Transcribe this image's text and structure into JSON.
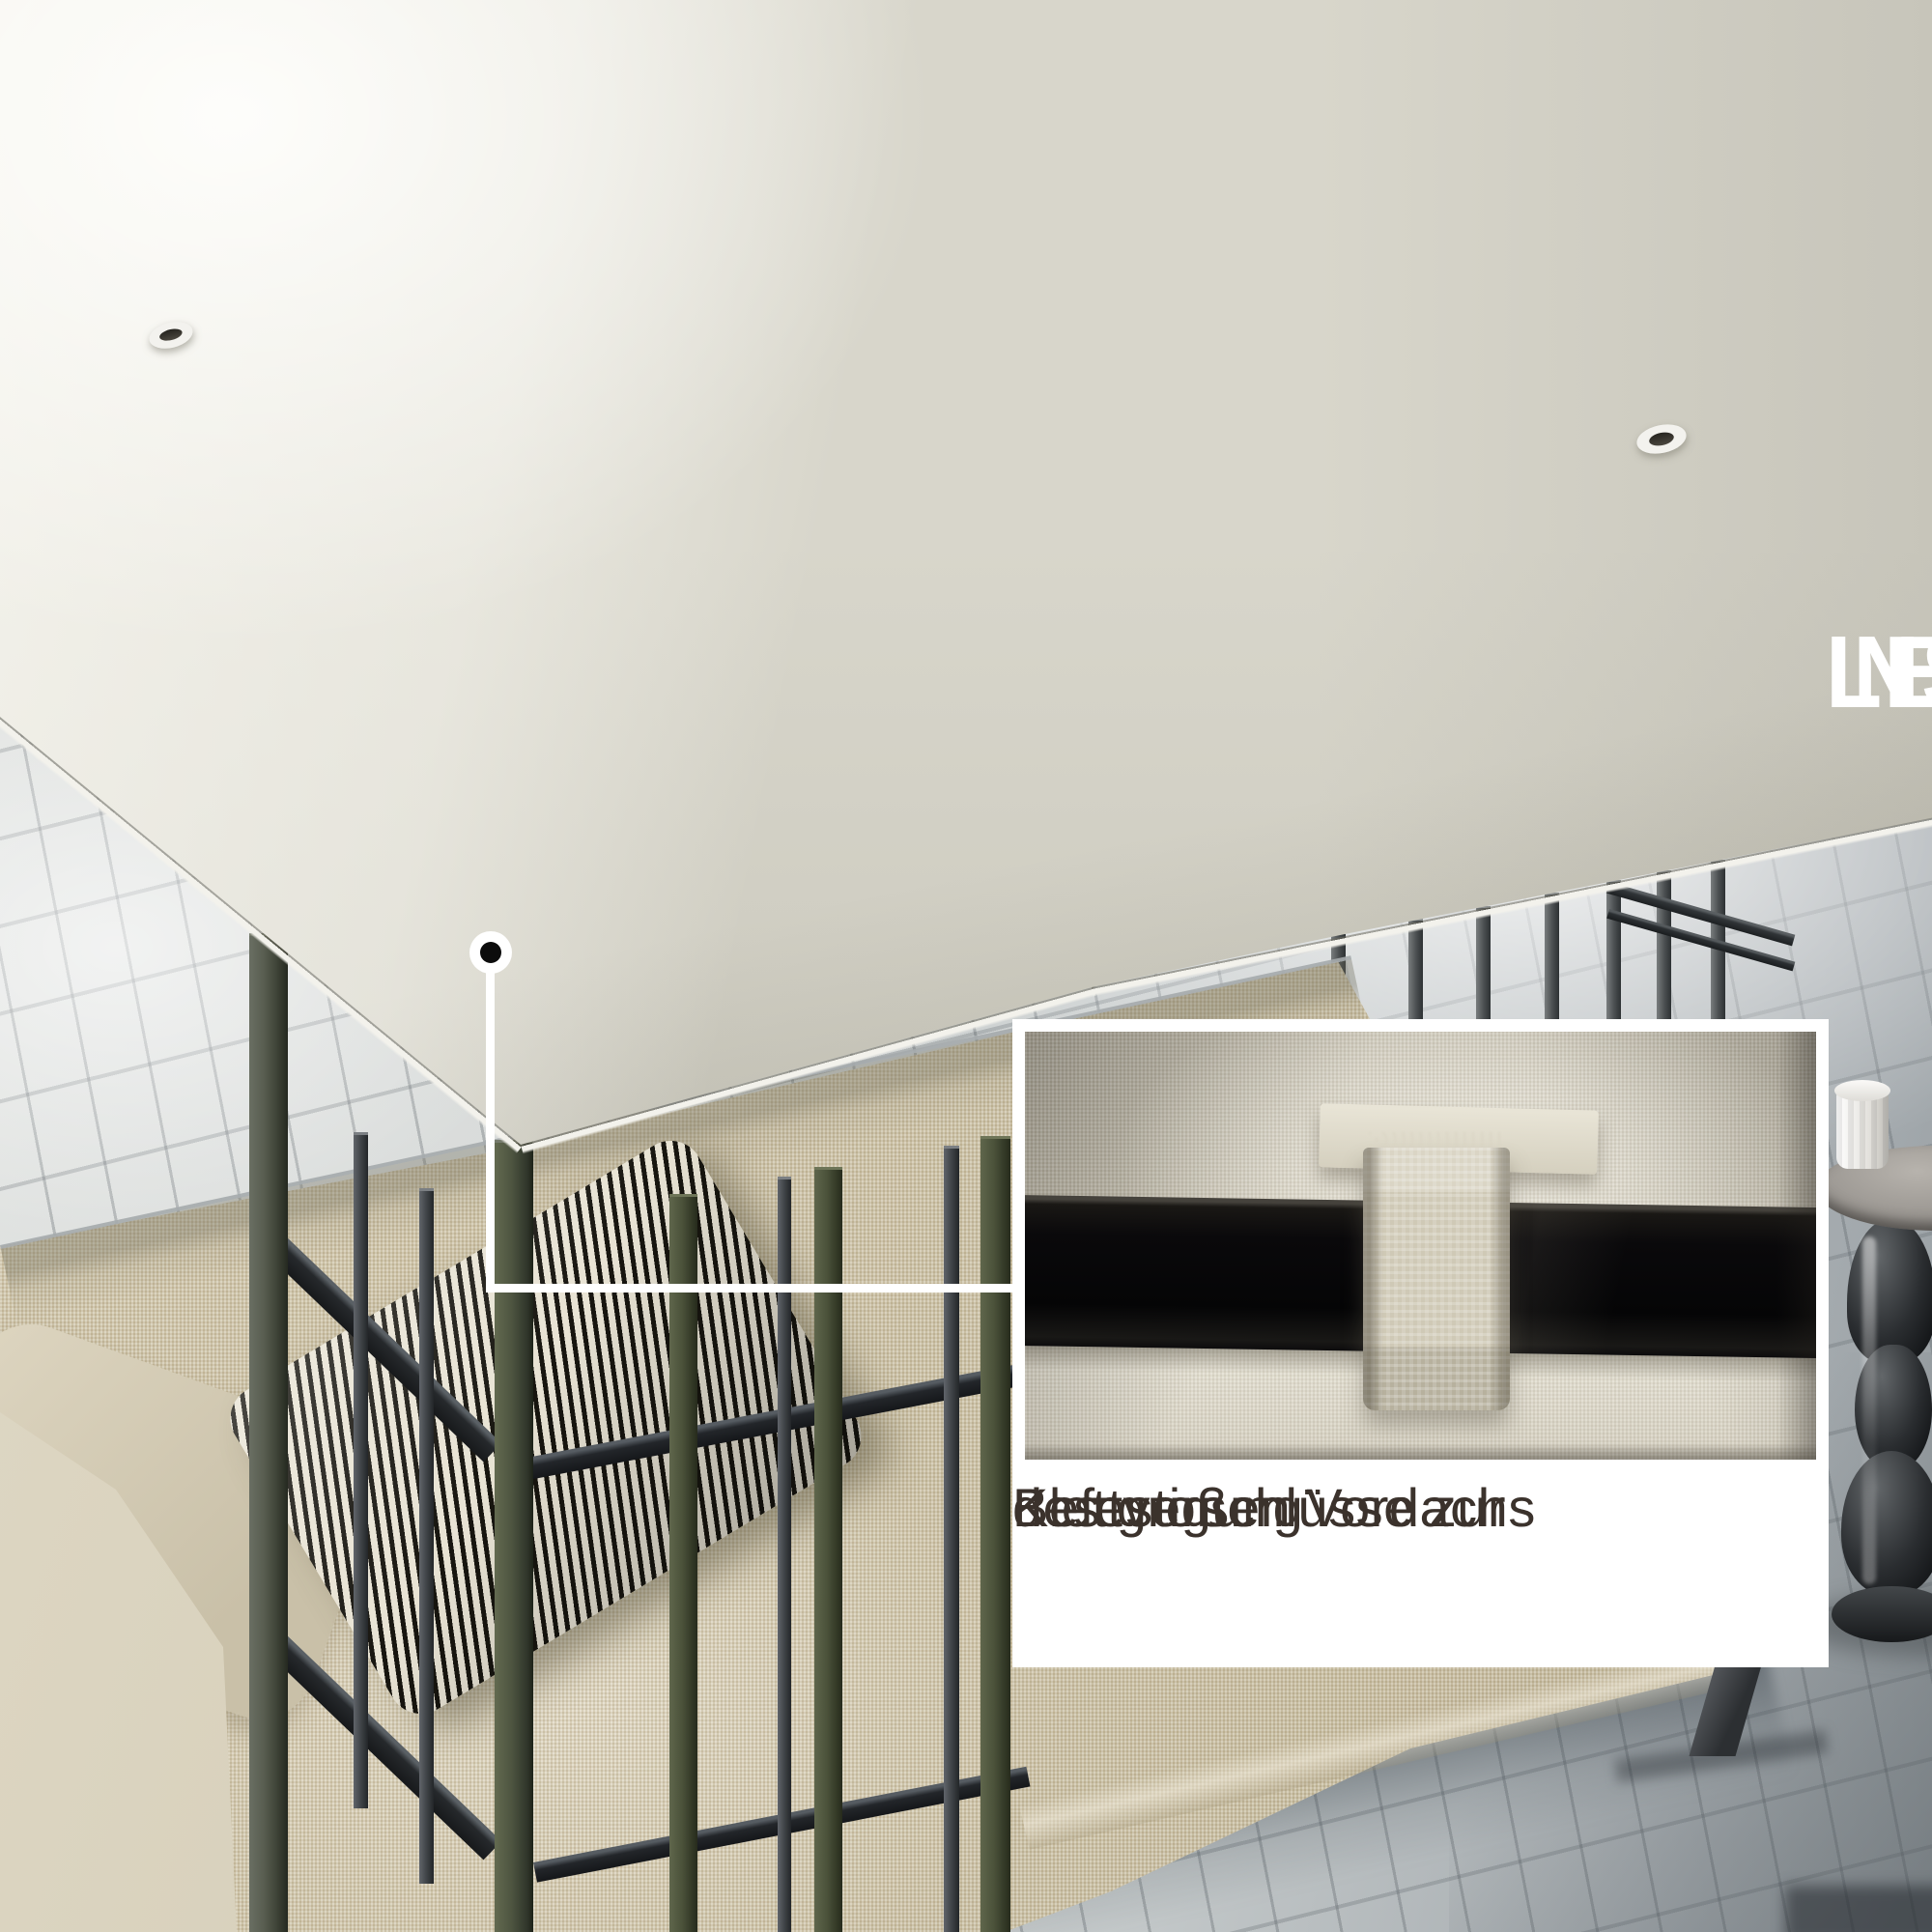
{
  "headline": {
    "line1": "LEICHT ZU",
    "line2": "INSTALLIEREN"
  },
  "inset": {
    "caption": {
      "line1": "Klettverschlüsse zur",
      "line2": "Befestigung",
      "line3": "des großen Vordachs"
    }
  },
  "colors": {
    "headline_text": "#ffffff",
    "caption_text": "#3b322c",
    "panel_bg": "#ffffff",
    "canopy_fabric": "#dcdacf",
    "canopy_fabric_shaded": "#c6c4b7",
    "sofa_fabric": "#cfc5aa",
    "pillow_stripe_dark": "#17150f",
    "pillow_stripe_light": "#e8e3d4",
    "frame_metal_dark": "#26292c",
    "frame_metal_olive": "#4b523a",
    "inset_bar_black": "#0a090b",
    "pavement_gray": "#c9cdcc",
    "callout_white": "#ffffff"
  }
}
